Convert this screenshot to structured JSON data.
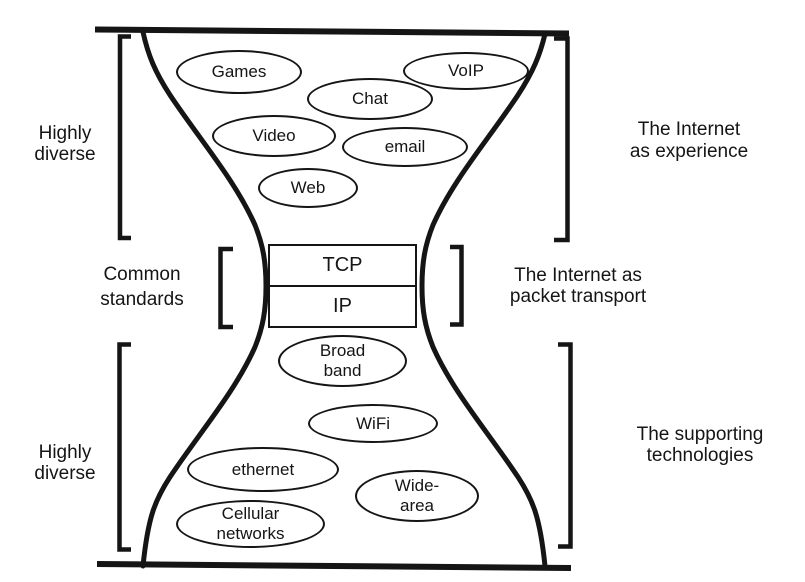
{
  "colors": {
    "ink": "#151515",
    "background": "#ffffff"
  },
  "top_section": {
    "left_bracket_label": {
      "lines": [
        "Highly",
        "diverse"
      ]
    },
    "right_label": {
      "lines": [
        "The Internet",
        "as experience"
      ]
    },
    "ovals": [
      {
        "name": "games",
        "lines": [
          "Games"
        ]
      },
      {
        "name": "voip",
        "lines": [
          "VoIP"
        ]
      },
      {
        "name": "chat",
        "lines": [
          "Chat"
        ]
      },
      {
        "name": "video",
        "lines": [
          "Video"
        ]
      },
      {
        "name": "email",
        "lines": [
          "email"
        ]
      },
      {
        "name": "web",
        "lines": [
          "Web"
        ]
      }
    ]
  },
  "neck_section": {
    "left_label": {
      "lines": [
        "Common",
        "standards"
      ]
    },
    "right_label": {
      "lines": [
        "The Internet as",
        "packet transport"
      ]
    },
    "layers": [
      {
        "name": "tcp",
        "label": "TCP"
      },
      {
        "name": "ip",
        "label": "IP"
      }
    ]
  },
  "bottom_section": {
    "left_bracket_label": {
      "lines": [
        "Highly",
        "diverse"
      ]
    },
    "right_label": {
      "lines": [
        "The supporting",
        "technologies"
      ]
    },
    "ovals": [
      {
        "name": "broadband",
        "lines": [
          "Broad",
          "band"
        ]
      },
      {
        "name": "wifi",
        "lines": [
          "WiFi"
        ]
      },
      {
        "name": "ethernet",
        "lines": [
          "ethernet"
        ]
      },
      {
        "name": "wide-area",
        "lines": [
          "Wide-",
          "area"
        ]
      },
      {
        "name": "cellular-networks",
        "lines": [
          "Cellular",
          "networks"
        ]
      }
    ]
  }
}
